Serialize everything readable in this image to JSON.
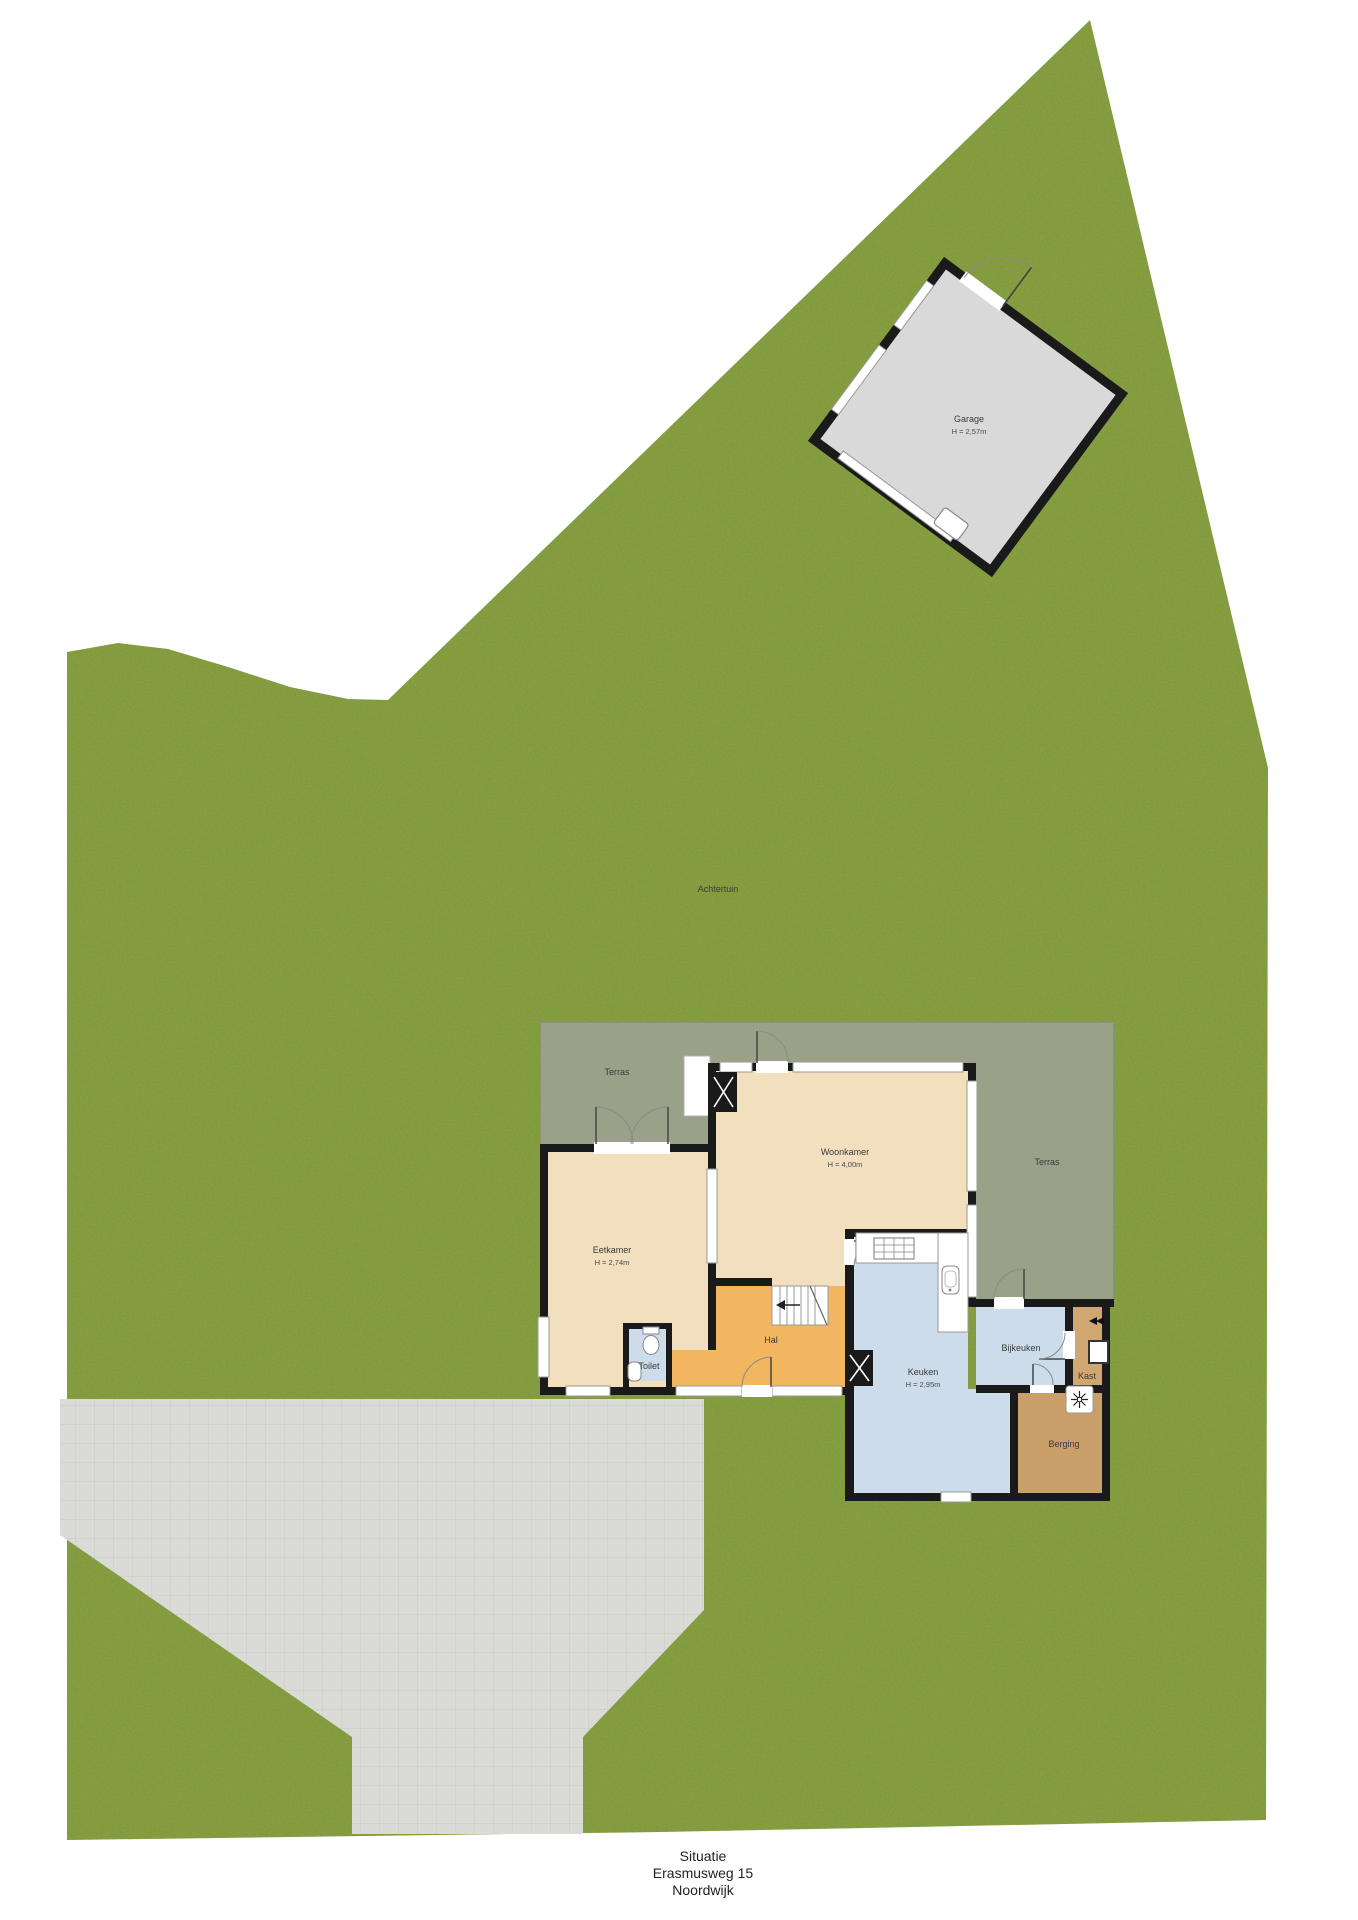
{
  "plan_title": {
    "line1": "Situatie",
    "line2": "Erasmusweg 15",
    "line3": "Noordwijk"
  },
  "garden": {
    "label": "Achtertuin"
  },
  "rooms": {
    "garage": {
      "label": "Garage",
      "height": "H = 2,57m"
    },
    "terras_left": {
      "label": "Terras"
    },
    "terras_right": {
      "label": "Terras"
    },
    "woonkamer": {
      "label": "Woonkamer",
      "height": "H = 4,00m"
    },
    "eetkamer": {
      "label": "Eetkamer",
      "height": "H = 2,74m"
    },
    "keuken": {
      "label": "Keuken",
      "height": "H = 2,95m"
    },
    "hal": {
      "label": "Hal"
    },
    "toilet": {
      "label": "Toilet"
    },
    "bijkeuken": {
      "label": "Bijkeuken"
    },
    "kast": {
      "label": "Kast"
    },
    "berging": {
      "label": "Berging"
    }
  },
  "colors": {
    "grass": "#7c9738",
    "terrace": "#9aa189",
    "floor_cream": "#f1dfbe",
    "floor_orange": "#f2b661",
    "floor_blue": "#ccdcea",
    "floor_tan": "#d0a673",
    "floor_brown": "#c9a06a",
    "garage_gray": "#d9d9d9",
    "driveway": "#dadbd7",
    "wall": "#1a1a1a"
  }
}
